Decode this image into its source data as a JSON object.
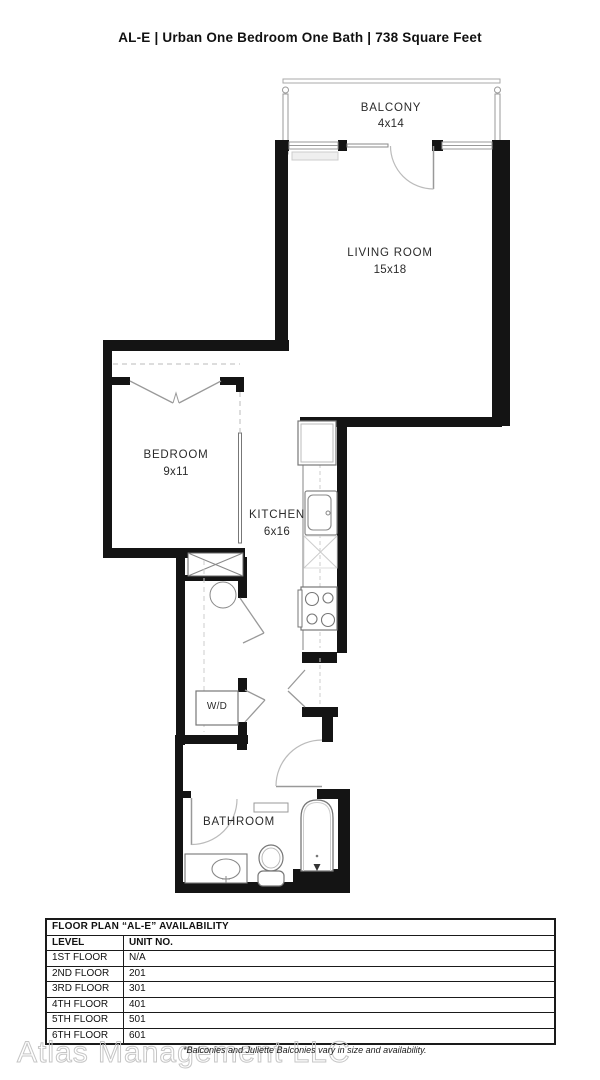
{
  "title": "AL-E | Urban One Bedroom One Bath | 738 Square Feet",
  "rooms": {
    "balcony": {
      "name": "BALCONY",
      "dims": "4x14"
    },
    "living": {
      "name": "LIVING ROOM",
      "dims": "15x18"
    },
    "bedroom": {
      "name": "BEDROOM",
      "dims": "9x11"
    },
    "kitchen": {
      "name": "KITCHEN",
      "dims": "6x16"
    },
    "laundry": {
      "name": "W/D"
    },
    "bathroom": {
      "name": "BATHROOM"
    }
  },
  "availability": {
    "title": "FLOOR PLAN “AL-E” AVAILABILITY",
    "columns": [
      "LEVEL",
      "UNIT NO."
    ],
    "rows": [
      {
        "level": "1ST FLOOR",
        "unit": "N/A"
      },
      {
        "level": "2ND FLOOR",
        "unit": "201"
      },
      {
        "level": "3RD FLOOR",
        "unit": "301"
      },
      {
        "level": "4TH FLOOR",
        "unit": "401"
      },
      {
        "level": "5TH FLOOR",
        "unit": "501"
      },
      {
        "level": "6TH FLOOR",
        "unit": "601"
      }
    ]
  },
  "footer": {
    "watermark": "Atlas Management LLC",
    "disclaimer": "*Balconies and Juliette Balconies vary in size and availability."
  },
  "colors": {
    "wall": "#141414",
    "thin_line": "#999999",
    "arc": "#bbbbbb"
  }
}
